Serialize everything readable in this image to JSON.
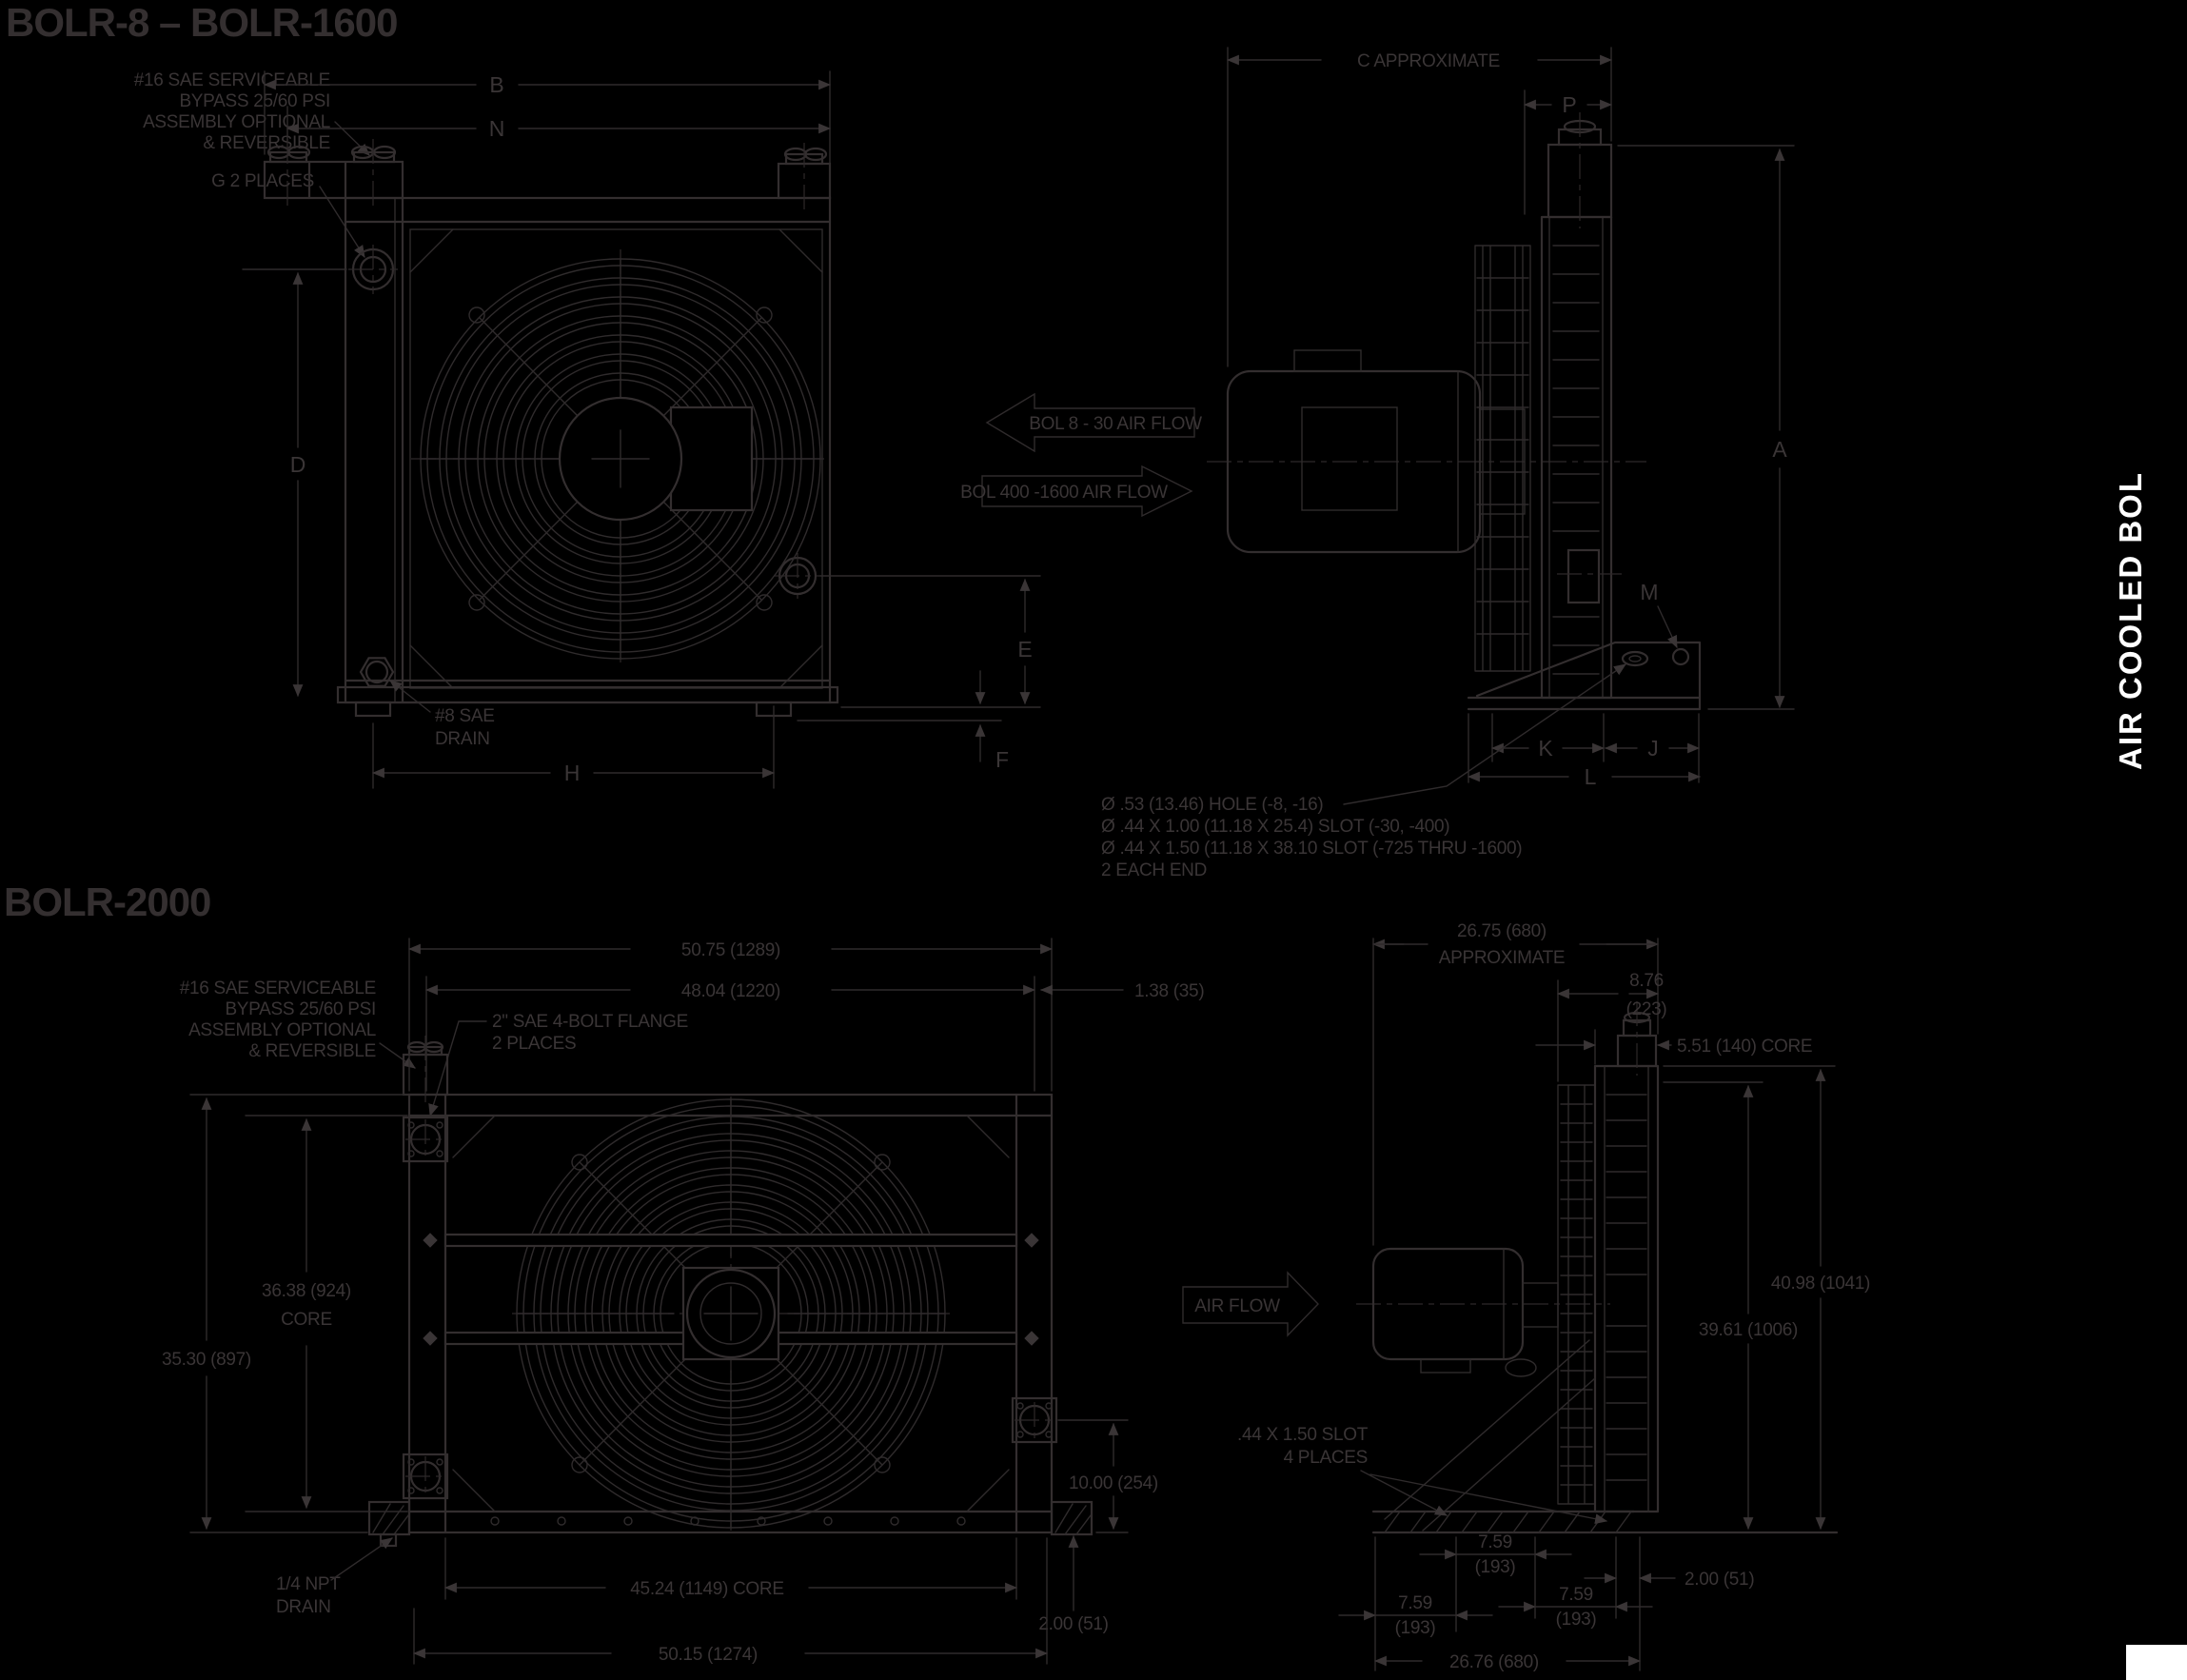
{
  "page": {
    "background": "#000000",
    "line_color": "#332e2f",
    "tab_color": "#ffffff"
  },
  "sections": {
    "top": {
      "title": "BOLR-8 – BOLR-1600",
      "bypass_note": [
        "#16 SAE SERVICEABLE",
        "BYPASS 25/60 PSI",
        "ASSEMBLY OPTIONAL",
        "& REVERSIBLE"
      ],
      "g_note": "G 2 PLACES",
      "drain_note": [
        "#8 SAE",
        "DRAIN"
      ],
      "airflow_left": "BOL 8 - 30 AIR FLOW",
      "airflow_right": "BOL 400 -1600 AIR FLOW",
      "hole_notes": [
        "Ø .53 (13.46) HOLE (-8, -16)",
        "Ø .44 X 1.00 (11.18 X 25.4) SLOT (-30, -400)",
        "Ø .44 X 1.50 (11.18 X 38.10 SLOT (-725 THRU -1600)",
        "2 EACH END"
      ],
      "dims": {
        "b": "B",
        "n": "N",
        "d": "D",
        "e": "E",
        "f": "F",
        "h": "H",
        "c": "C APPROXIMATE",
        "p": "P",
        "a": "A",
        "m": "M",
        "k": "K",
        "j": "J",
        "l": "L"
      }
    },
    "bottom": {
      "title": "BOLR-2000",
      "bypass_note": [
        "#16 SAE SERVICEABLE",
        "BYPASS 25/60 PSI",
        "ASSEMBLY OPTIONAL",
        "& REVERSIBLE"
      ],
      "flange_note": [
        "2\" SAE 4-BOLT FLANGE",
        "2 PLACES"
      ],
      "drain_note": [
        "1/4 NPT",
        "DRAIN"
      ],
      "slot_note": [
        ".44 X 1.50 SLOT",
        "4 PLACES"
      ],
      "airflow": "AIR FLOW",
      "dims": {
        "width_overall": "50.75 (1289)",
        "width_inner": "48.04  (1220)",
        "offset_right": "1.38 (35)",
        "core_height_in": "36.38  (924)",
        "core_height_label": "CORE",
        "height_overall_left": "35.30 (897)",
        "core_width": "45.24 (1149)  CORE",
        "base_width": "50.15 (1274)",
        "port_height": "10.00  (254)",
        "base_height": "2.00 (51)",
        "depth_line1": "26.75   (680)",
        "depth_line2": "APPROXIMATE",
        "shroud_depth_in": "8.76",
        "shroud_depth_mm": "(223)",
        "core_thickness": "5.51 (140)   CORE",
        "height_overall": "40.98 (1041)",
        "height_core_top": "39.61  (1006)",
        "foot_in": "7.59",
        "foot_mm": "(193)",
        "foot_edge": "2.00 (51)",
        "base_depth": "26.76  (680)"
      }
    }
  },
  "sidebar": {
    "text": "AIR COOLED  BOL"
  }
}
